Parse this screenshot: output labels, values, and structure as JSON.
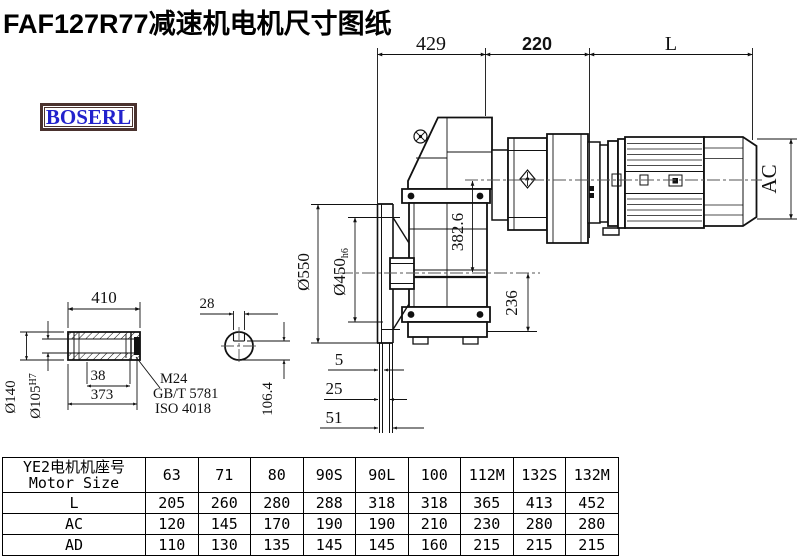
{
  "title": "FAF127R77减速机电机尺寸图纸",
  "logo": {
    "text": "BOSERL",
    "text_color": "#2222cc",
    "border_color": "#4a322e"
  },
  "drawing": {
    "top_dims": {
      "d429": "429",
      "d220": "220",
      "dL": "L"
    },
    "side_dims": {
      "ac": "AC",
      "d382": "382.6",
      "d236": "236"
    },
    "flange_dims": {
      "d550": "Ø550",
      "d450": "Ø450",
      "d450_tol": "h6",
      "d5": "5",
      "d25": "25",
      "d51": "51"
    },
    "shaft_dims": {
      "d410": "410",
      "d140": "Ø140",
      "d105": "Ø105",
      "d105_tol": "H7",
      "d38": "38",
      "d373": "373",
      "thread": "M24",
      "std1": "GB/T 5781",
      "std2": "ISO 4018"
    },
    "section_dims": {
      "d28": "28",
      "d106": "106.4"
    }
  },
  "table": {
    "row_header_line1": "YE2电机机座号",
    "row_header_line2": "Motor Size",
    "columns": [
      "63",
      "71",
      "80",
      "90S",
      "90L",
      "100",
      "112M",
      "132S",
      "132M"
    ],
    "rows": [
      {
        "label": "L",
        "values": [
          "205",
          "260",
          "280",
          "288",
          "318",
          "318",
          "365",
          "413",
          "452"
        ]
      },
      {
        "label": "AC",
        "values": [
          "120",
          "145",
          "170",
          "190",
          "190",
          "210",
          "230",
          "280",
          "280"
        ]
      },
      {
        "label": "AD",
        "values": [
          "110",
          "130",
          "135",
          "145",
          "145",
          "160",
          "215",
          "215",
          "215"
        ]
      }
    ]
  }
}
